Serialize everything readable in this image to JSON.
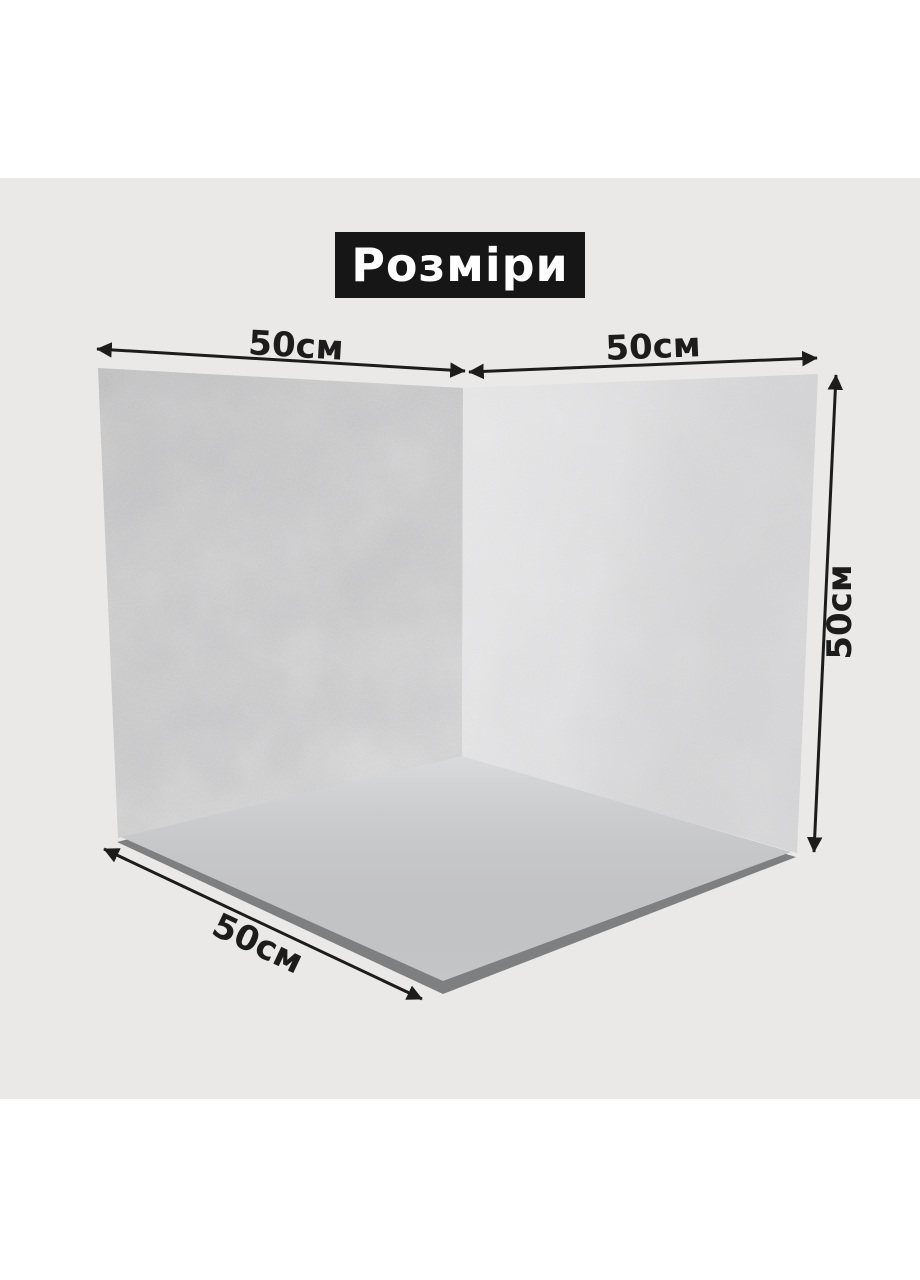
{
  "page": {
    "background": "#ffffff",
    "canvas_background": "#eae9e7"
  },
  "title_badge": {
    "label": "Розміри",
    "bg_color": "#161616",
    "text_color": "#ffffff"
  },
  "annotations": {
    "color": "#1c1c1c",
    "left_wall_width": "50см",
    "right_wall_width": "50см",
    "right_wall_height": "50см",
    "floor_depth": "50см"
  },
  "backdrop": {
    "left_wall_color": "#c6c6c8",
    "right_wall_color": "#dadadc",
    "floor_color": "#cfd0d2",
    "floor_edge_color": "#7e7f81"
  }
}
